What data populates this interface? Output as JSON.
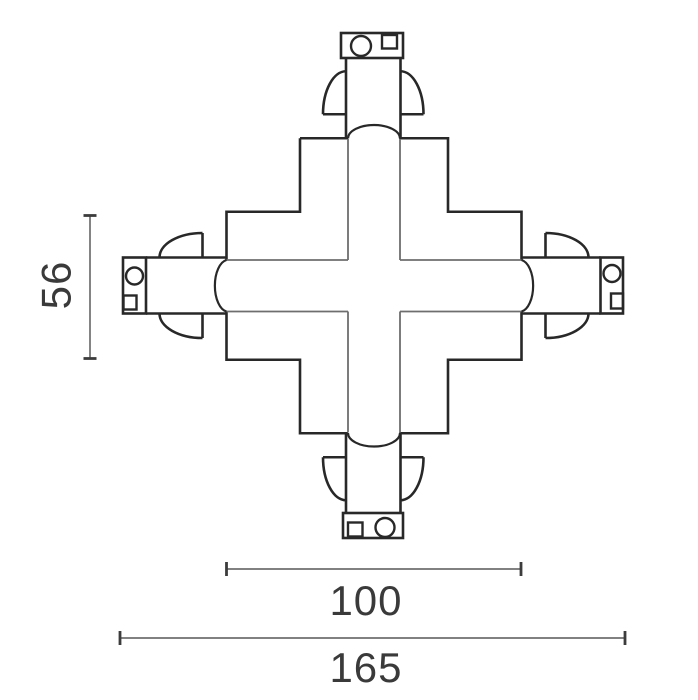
{
  "dimensions": {
    "track_height": "56",
    "inner_width": "100",
    "overall_width": "165"
  },
  "colors": {
    "background": "#ffffff",
    "outline": "#282828",
    "secondary_line": "#6e6e6e",
    "dimension_line": "#6f6f6f",
    "dimension_tick": "#3c3c3c",
    "dimension_text": "#3a3a3a"
  }
}
